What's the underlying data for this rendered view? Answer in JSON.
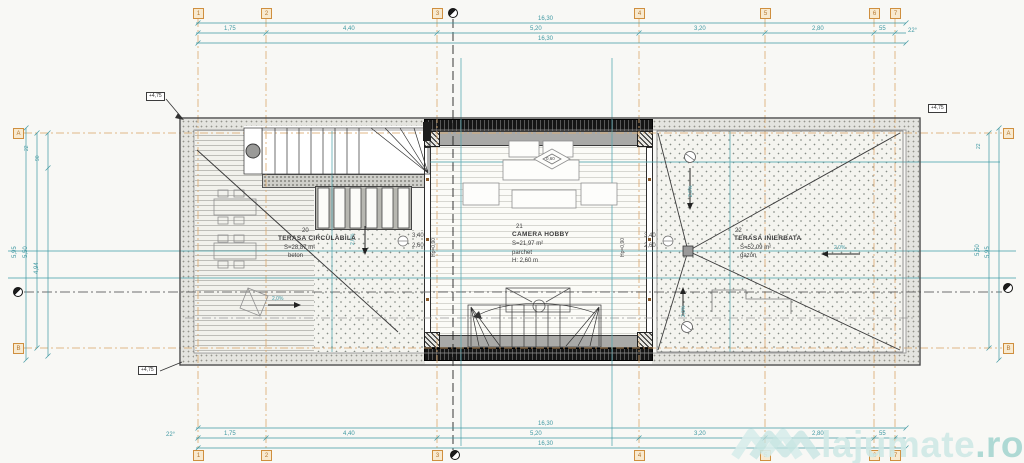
{
  "watermark": {
    "brand": "lajumate",
    "tld": ".ro"
  },
  "levels": {
    "top_left": "+4,75",
    "bottom_left": "+4,75",
    "top_right": "+4,75"
  },
  "grid": {
    "cols": [
      "1",
      "2",
      "3",
      "4",
      "5",
      "6",
      "7"
    ],
    "row_top": "A",
    "row_bottom": "B"
  },
  "dims": {
    "top": {
      "overall_upper": "16,30",
      "overall_lower": "16,30",
      "segments": [
        "1,75",
        "4,40",
        "5,20",
        "3,20",
        "2,80",
        "55"
      ],
      "angle": "22°"
    },
    "bottom": {
      "overall_upper": "16,30",
      "overall_lower": "16,30",
      "segments": [
        "1,75",
        "4,40",
        "5,20",
        "3,20",
        "2,80",
        "55"
      ],
      "angle": "22°"
    },
    "left": {
      "outer": "5,95",
      "middle": "5,50",
      "inner": "4,94",
      "small_a": "22",
      "small_b": "90"
    },
    "right": {
      "inner": "5,50",
      "outer": "5,95",
      "small": "22"
    },
    "window_left": {
      "a": "3,40",
      "b": "2,60"
    },
    "window_right": {
      "a": "3,40",
      "b": "2,60"
    },
    "parapet_left": "Hp=0,90",
    "parapet_right": "Hp=0,90",
    "skylight": "0,60"
  },
  "slopes": {
    "left_deck": "2,0%",
    "left_gravel": "2,0%",
    "right_top": "2,0%",
    "right_bottom": "2,0%",
    "right_side": "2,0%"
  },
  "rooms": {
    "hobby": {
      "number": "21",
      "name": "CAMERA HOBBY",
      "area": "S=21,97 m²",
      "finish": "parchet",
      "height": "H: 2,60 m"
    },
    "terrace_left": {
      "number": "20",
      "name": "TERASA CIRCULABILA",
      "area": "S=28,87 m²",
      "finish": "beton"
    },
    "terrace_right": {
      "number": "22",
      "name": "TERASA INIERBATA",
      "area": "S=52,09 m²",
      "finish": "gazon"
    }
  }
}
